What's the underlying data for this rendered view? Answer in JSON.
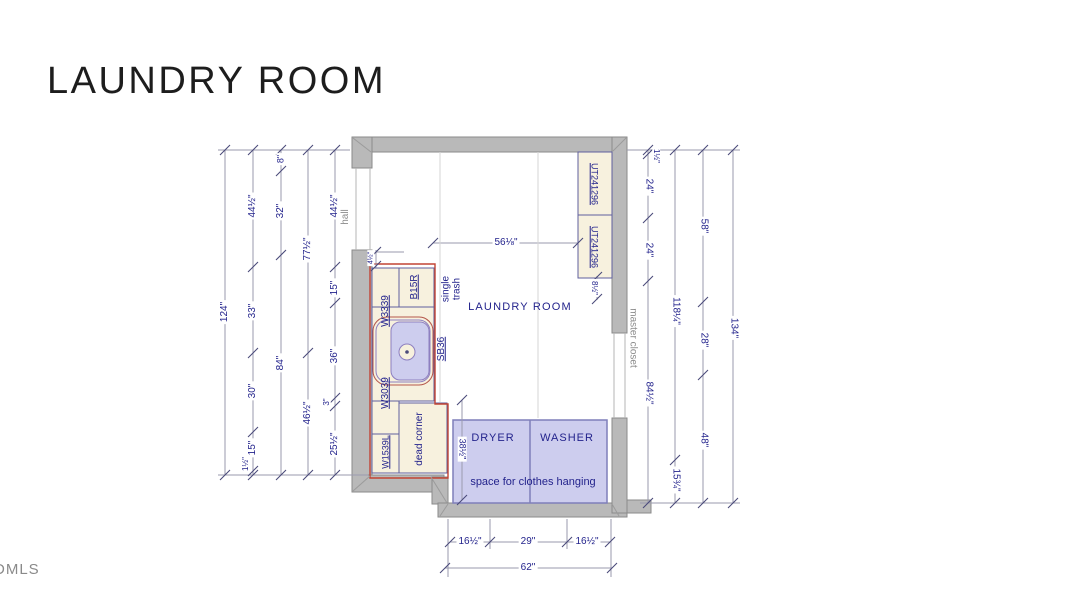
{
  "page": {
    "title": "LAUNDRY ROOM",
    "watermark": "DMLS"
  },
  "plan": {
    "colors": {
      "wallFill": "#b9b9b9",
      "wallStroke": "#8a8a8a",
      "cabFill": "#f7f1de",
      "cabStroke": "#5f5f9e",
      "lavFill": "#cdcdee",
      "appStroke": "#7f7fba",
      "red": "#c24434",
      "purple": "#8d7fc0",
      "sinkRed": "#b4564a",
      "dimLine": "#9a9aae",
      "tick": "#4a4a7a",
      "navy": "#23238c",
      "gray": "#8c8c8c",
      "seam": "#d6d6d6",
      "jamb": "#b5b5b5",
      "diag": "#9b9b9b",
      "none": "none"
    },
    "rects": [
      {
        "x": 352,
        "y": 137,
        "w": 275,
        "h": 15,
        "f": "wallFill",
        "st": "wallStroke",
        "name": "wall-top"
      },
      {
        "x": 352,
        "y": 137,
        "w": 20,
        "h": 31,
        "f": "wallFill",
        "st": "wallStroke",
        "name": "wall-left-upper"
      },
      {
        "x": 352,
        "y": 250,
        "w": 20,
        "h": 242,
        "f": "wallFill",
        "st": "wallStroke",
        "name": "wall-left"
      },
      {
        "x": 352,
        "y": 475,
        "w": 92,
        "h": 17,
        "f": "wallFill",
        "st": "wallStroke",
        "name": "wall-bottom-left"
      },
      {
        "x": 432,
        "y": 477,
        "w": 16,
        "h": 27,
        "f": "wallFill",
        "st": "wallStroke",
        "name": "wall-step"
      },
      {
        "x": 438,
        "y": 503,
        "w": 189,
        "h": 14,
        "f": "wallFill",
        "st": "wallStroke",
        "name": "wall-bottom"
      },
      {
        "x": 612,
        "y": 137,
        "w": 15,
        "h": 196,
        "f": "wallFill",
        "st": "wallStroke",
        "name": "wall-right-upper"
      },
      {
        "x": 612,
        "y": 418,
        "w": 15,
        "h": 95,
        "f": "wallFill",
        "st": "wallStroke",
        "name": "wall-right-lower"
      },
      {
        "x": 627,
        "y": 500,
        "w": 24,
        "h": 13,
        "f": "wallFill",
        "st": "wallStroke",
        "name": "wall-stub-right"
      },
      {
        "x": 372,
        "y": 268,
        "w": 27,
        "h": 87,
        "f": "cabFill",
        "st": "cabStroke",
        "name": "cabinet-w3339"
      },
      {
        "x": 372,
        "y": 355,
        "w": 27,
        "h": 79,
        "f": "cabFill",
        "st": "cabStroke",
        "name": "cabinet-w3039"
      },
      {
        "x": 372,
        "y": 434,
        "w": 27,
        "h": 39,
        "f": "cabFill",
        "st": "cabStroke",
        "name": "cabinet-w1539l"
      },
      {
        "x": 399,
        "y": 268,
        "w": 35,
        "h": 39,
        "f": "cabFill",
        "st": "cabStroke",
        "name": "cabinet-b15r"
      },
      {
        "x": 372,
        "y": 307,
        "w": 62,
        "h": 94,
        "f": "cabFill",
        "st": "cabStroke",
        "name": "cabinet-sb36"
      },
      {
        "x": 399,
        "y": 403,
        "w": 48,
        "h": 70,
        "f": "cabFill",
        "st": "cabStroke",
        "name": "dead-corner-area"
      },
      {
        "x": 578,
        "y": 152,
        "w": 34,
        "h": 63,
        "f": "cabFill",
        "st": "cabStroke",
        "name": "cabinet-ut241296-upper"
      },
      {
        "x": 578,
        "y": 215,
        "w": 34,
        "h": 63,
        "f": "cabFill",
        "st": "cabStroke",
        "name": "cabinet-ut241296-lower"
      },
      {
        "x": 373,
        "y": 317,
        "w": 60,
        "h": 68,
        "rx": 14,
        "f": "cabFill",
        "st": "sinkRed",
        "name": "sink-outer"
      },
      {
        "x": 376,
        "y": 320,
        "w": 54,
        "h": 62,
        "rx": 11,
        "f": "none",
        "st": "purple",
        "name": "sink-rim"
      },
      {
        "x": 391,
        "y": 322,
        "w": 38,
        "h": 58,
        "rx": 9,
        "f": "lavFill",
        "st": "purple",
        "name": "sink-basin"
      },
      {
        "x": 453,
        "y": 420,
        "w": 154,
        "h": 83,
        "f": "lavFill",
        "st": "appStroke",
        "sw": 1.5,
        "name": "washer-dryer-area"
      }
    ],
    "circles": [
      {
        "cx": 407,
        "cy": 352,
        "r": 8,
        "f": "cabFill",
        "st": "purple",
        "name": "sink-drain"
      },
      {
        "cx": 407,
        "cy": 352,
        "r": 1.8,
        "f": "tick",
        "st": "none",
        "name": "sink-drain-dot"
      }
    ],
    "paths": [
      {
        "d": "M370,264 L435,264 L435,404 L448,404 L448,478 L370,478 Z",
        "st": "red",
        "sw": 1.4,
        "name": "cabinet-run-outline"
      }
    ],
    "lines": [
      [
        225,
        150,
        225,
        475
      ],
      [
        253,
        150,
        253,
        475
      ],
      [
        281,
        150,
        281,
        475
      ],
      [
        308,
        150,
        308,
        475
      ],
      [
        335,
        150,
        335,
        475
      ],
      [
        648,
        150,
        648,
        503
      ],
      [
        675,
        150,
        675,
        503
      ],
      [
        703,
        150,
        703,
        503
      ],
      [
        733,
        150,
        733,
        503
      ],
      [
        218,
        150,
        350,
        150
      ],
      [
        218,
        475,
        368,
        475
      ],
      [
        627,
        150,
        740,
        150
      ],
      [
        640,
        503,
        740,
        503
      ],
      [
        450,
        542,
        610,
        542
      ],
      [
        445,
        568,
        612,
        568
      ],
      [
        448,
        519,
        448,
        577
      ],
      [
        611,
        519,
        611,
        577
      ],
      [
        490,
        519,
        490,
        549
      ],
      [
        567,
        519,
        567,
        549
      ],
      [
        433,
        243,
        578,
        243
      ],
      [
        462,
        400,
        462,
        500
      ],
      [
        376,
        250,
        376,
        268
      ],
      [
        376,
        252,
        404,
        252
      ],
      [
        597,
        276,
        597,
        300
      ],
      [
        440,
        152,
        440,
        402,
        "s"
      ],
      [
        538,
        152,
        538,
        418,
        "s"
      ],
      [
        356,
        168,
        356,
        250,
        "j"
      ],
      [
        370,
        168,
        370,
        250,
        "j"
      ],
      [
        614,
        333,
        614,
        418,
        "j"
      ],
      [
        625,
        333,
        625,
        418,
        "j"
      ],
      [
        353,
        138,
        371,
        152,
        "g"
      ],
      [
        626,
        138,
        613,
        151,
        "g"
      ],
      [
        353,
        491,
        370,
        476,
        "g"
      ],
      [
        431,
        477,
        447,
        503,
        "g"
      ],
      [
        440,
        516,
        448,
        504,
        "g"
      ],
      [
        619,
        516,
        612,
        504,
        "g"
      ],
      [
        530,
        420,
        530,
        503,
        "app"
      ]
    ],
    "ticks": [
      [
        225,
        150
      ],
      [
        225,
        475
      ],
      [
        253,
        150
      ],
      [
        253,
        267
      ],
      [
        253,
        353
      ],
      [
        253,
        432
      ],
      [
        253,
        471
      ],
      [
        253,
        475
      ],
      [
        281,
        150
      ],
      [
        281,
        171
      ],
      [
        281,
        255
      ],
      [
        281,
        475
      ],
      [
        308,
        150
      ],
      [
        308,
        353
      ],
      [
        308,
        475
      ],
      [
        335,
        150
      ],
      [
        335,
        267
      ],
      [
        335,
        303
      ],
      [
        335,
        398
      ],
      [
        335,
        406
      ],
      [
        335,
        475
      ],
      [
        648,
        150
      ],
      [
        648,
        154
      ],
      [
        648,
        218
      ],
      [
        648,
        281
      ],
      [
        648,
        503
      ],
      [
        675,
        150
      ],
      [
        675,
        460
      ],
      [
        675,
        503
      ],
      [
        703,
        150
      ],
      [
        703,
        302
      ],
      [
        703,
        375
      ],
      [
        703,
        503
      ],
      [
        733,
        150
      ],
      [
        733,
        503
      ],
      [
        450,
        542
      ],
      [
        490,
        542
      ],
      [
        567,
        542
      ],
      [
        610,
        542
      ],
      [
        445,
        568
      ],
      [
        612,
        568
      ],
      [
        433,
        243
      ],
      [
        578,
        243
      ],
      [
        462,
        400
      ],
      [
        462,
        500
      ],
      [
        376,
        252
      ],
      [
        376,
        266
      ],
      [
        597,
        277
      ],
      [
        597,
        299
      ]
    ],
    "labels": [
      {
        "t": "124\"",
        "x": 225,
        "y": 312,
        "r": -90,
        "bg": 1,
        "name": "dim-124"
      },
      {
        "t": "44½\"",
        "x": 253,
        "y": 206,
        "r": -90,
        "bg": 1,
        "name": "dim-44half-left"
      },
      {
        "t": "33\"",
        "x": 253,
        "y": 311,
        "r": -90,
        "bg": 1,
        "name": "dim-33"
      },
      {
        "t": "30\"",
        "x": 253,
        "y": 391,
        "r": -90,
        "bg": 1,
        "name": "dim-30"
      },
      {
        "t": "15\"",
        "x": 253,
        "y": 448,
        "r": -90,
        "bg": 1,
        "name": "dim-15-left"
      },
      {
        "t": "1½\"",
        "x": 246,
        "y": 464,
        "r": -90,
        "s": 8,
        "bg": 1,
        "name": "dim-1half-left"
      },
      {
        "t": "8\"",
        "x": 281,
        "y": 159,
        "r": -90,
        "s": 9,
        "bg": 1,
        "name": "dim-8"
      },
      {
        "t": "32\"",
        "x": 281,
        "y": 211,
        "r": -90,
        "bg": 1,
        "name": "dim-32"
      },
      {
        "t": "84\"",
        "x": 281,
        "y": 363,
        "r": -90,
        "bg": 1,
        "name": "dim-84"
      },
      {
        "t": "77½\"",
        "x": 308,
        "y": 249,
        "r": -90,
        "bg": 1,
        "name": "dim-77half"
      },
      {
        "t": "46½\"",
        "x": 308,
        "y": 413,
        "r": -90,
        "bg": 1,
        "name": "dim-46half"
      },
      {
        "t": "44½\"",
        "x": 335,
        "y": 206,
        "r": -90,
        "bg": 1,
        "name": "dim-44half-hall"
      },
      {
        "t": "hall",
        "x": 346,
        "y": 217,
        "r": -90,
        "c": "gray",
        "name": "hall-label"
      },
      {
        "t": "15\"",
        "x": 335,
        "y": 288,
        "r": -90,
        "bg": 1,
        "name": "dim-15-wall"
      },
      {
        "t": "36\"",
        "x": 335,
        "y": 356,
        "r": -90,
        "bg": 1,
        "name": "dim-36"
      },
      {
        "t": "3\"",
        "x": 327,
        "y": 402,
        "r": -90,
        "s": 8,
        "bg": 1,
        "name": "dim-3"
      },
      {
        "t": "25½\"",
        "x": 335,
        "y": 444,
        "r": -90,
        "bg": 1,
        "name": "dim-25half"
      },
      {
        "t": "4½\"",
        "x": 371,
        "y": 258,
        "r": -90,
        "s": 7,
        "bg": 1,
        "name": "dim-4half"
      },
      {
        "t": "1½\"",
        "x": 656,
        "y": 156,
        "r": 90,
        "s": 8,
        "bg": 1,
        "name": "dim-1half-right"
      },
      {
        "t": "24\"",
        "x": 648,
        "y": 186,
        "r": 90,
        "bg": 1,
        "name": "dim-24-upper"
      },
      {
        "t": "24\"",
        "x": 648,
        "y": 250,
        "r": 90,
        "bg": 1,
        "name": "dim-24-lower"
      },
      {
        "t": "84½\"",
        "x": 648,
        "y": 393,
        "r": 90,
        "bg": 1,
        "name": "dim-84half"
      },
      {
        "t": "118¼\"",
        "x": 675,
        "y": 311,
        "r": 90,
        "bg": 1,
        "name": "dim-118quarter"
      },
      {
        "t": "15¾\"",
        "x": 675,
        "y": 480,
        "r": 90,
        "bg": 1,
        "name": "dim-15threequarter"
      },
      {
        "t": "58\"",
        "x": 703,
        "y": 226,
        "r": 90,
        "bg": 1,
        "name": "dim-58"
      },
      {
        "t": "28\"",
        "x": 703,
        "y": 340,
        "r": 90,
        "bg": 1,
        "name": "dim-28"
      },
      {
        "t": "48\"",
        "x": 703,
        "y": 440,
        "r": 90,
        "bg": 1,
        "name": "dim-48"
      },
      {
        "t": "134\"",
        "x": 733,
        "y": 328,
        "r": 90,
        "bg": 1,
        "name": "dim-134"
      },
      {
        "t": "8½\"",
        "x": 594,
        "y": 288,
        "r": 90,
        "s": 8,
        "bg": 1,
        "name": "dim-8half"
      },
      {
        "t": "38½\"",
        "x": 462,
        "y": 449,
        "r": 90,
        "s": 9,
        "bg": 1,
        "name": "dim-38half"
      },
      {
        "t": "master closet",
        "x": 632,
        "y": 338,
        "r": 90,
        "c": "gray",
        "name": "master-closet-label"
      },
      {
        "t": "16½\"",
        "x": 470,
        "y": 542,
        "r": 0,
        "bg": 1,
        "name": "dim-16half-left"
      },
      {
        "t": "29\"",
        "x": 528,
        "y": 542,
        "r": 0,
        "bg": 1,
        "name": "dim-29"
      },
      {
        "t": "16½\"",
        "x": 587,
        "y": 542,
        "r": 0,
        "bg": 1,
        "name": "dim-16half-right"
      },
      {
        "t": "62\"",
        "x": 528,
        "y": 568,
        "r": 0,
        "bg": 1,
        "name": "dim-62"
      },
      {
        "t": "56⅛\"",
        "x": 506,
        "y": 243,
        "r": 0,
        "bg": 1,
        "name": "dim-56eighth"
      },
      {
        "t": "LAUNDRY ROOM",
        "x": 520,
        "y": 308,
        "r": 0,
        "s": 11,
        "ls": 1.2,
        "name": "room-label"
      },
      {
        "t": "DRYER",
        "x": 493,
        "y": 439,
        "r": 0,
        "s": 11,
        "ls": 1,
        "name": "dryer-label"
      },
      {
        "t": "WASHER",
        "x": 567,
        "y": 439,
        "r": 0,
        "s": 11,
        "ls": 1,
        "name": "washer-label"
      },
      {
        "t": "space for clothes hanging",
        "x": 533,
        "y": 483,
        "r": 0,
        "s": 11,
        "name": "hanging-space-label"
      },
      {
        "t": "single\ntrash",
        "x": 452,
        "y": 289,
        "r": -90,
        "name": "single-trash-label"
      },
      {
        "t": "W3339",
        "x": 386,
        "y": 311,
        "r": -90,
        "u": 1,
        "name": "cabinet-label-w3339"
      },
      {
        "t": "W3039",
        "x": 386,
        "y": 393,
        "r": -90,
        "u": 1,
        "name": "cabinet-label-w3039"
      },
      {
        "t": "W1539L",
        "x": 386,
        "y": 452,
        "r": -90,
        "u": 1,
        "s": 9,
        "name": "cabinet-label-w1539l"
      },
      {
        "t": "B15R",
        "x": 415,
        "y": 287,
        "r": -90,
        "u": 1,
        "name": "cabinet-label-b15r"
      },
      {
        "t": "SB36",
        "x": 442,
        "y": 349,
        "r": -90,
        "u": 1,
        "name": "cabinet-label-sb36"
      },
      {
        "t": "dead corner",
        "x": 420,
        "y": 439,
        "r": -90,
        "name": "dead-corner-label"
      },
      {
        "t": "UT241296",
        "x": 594,
        "y": 184,
        "r": 90,
        "u": 1,
        "s": 9,
        "name": "cabinet-label-ut241296-upper"
      },
      {
        "t": "UT241296",
        "x": 594,
        "y": 247,
        "r": 90,
        "u": 1,
        "s": 9,
        "name": "cabinet-label-ut241296-lower"
      }
    ]
  }
}
